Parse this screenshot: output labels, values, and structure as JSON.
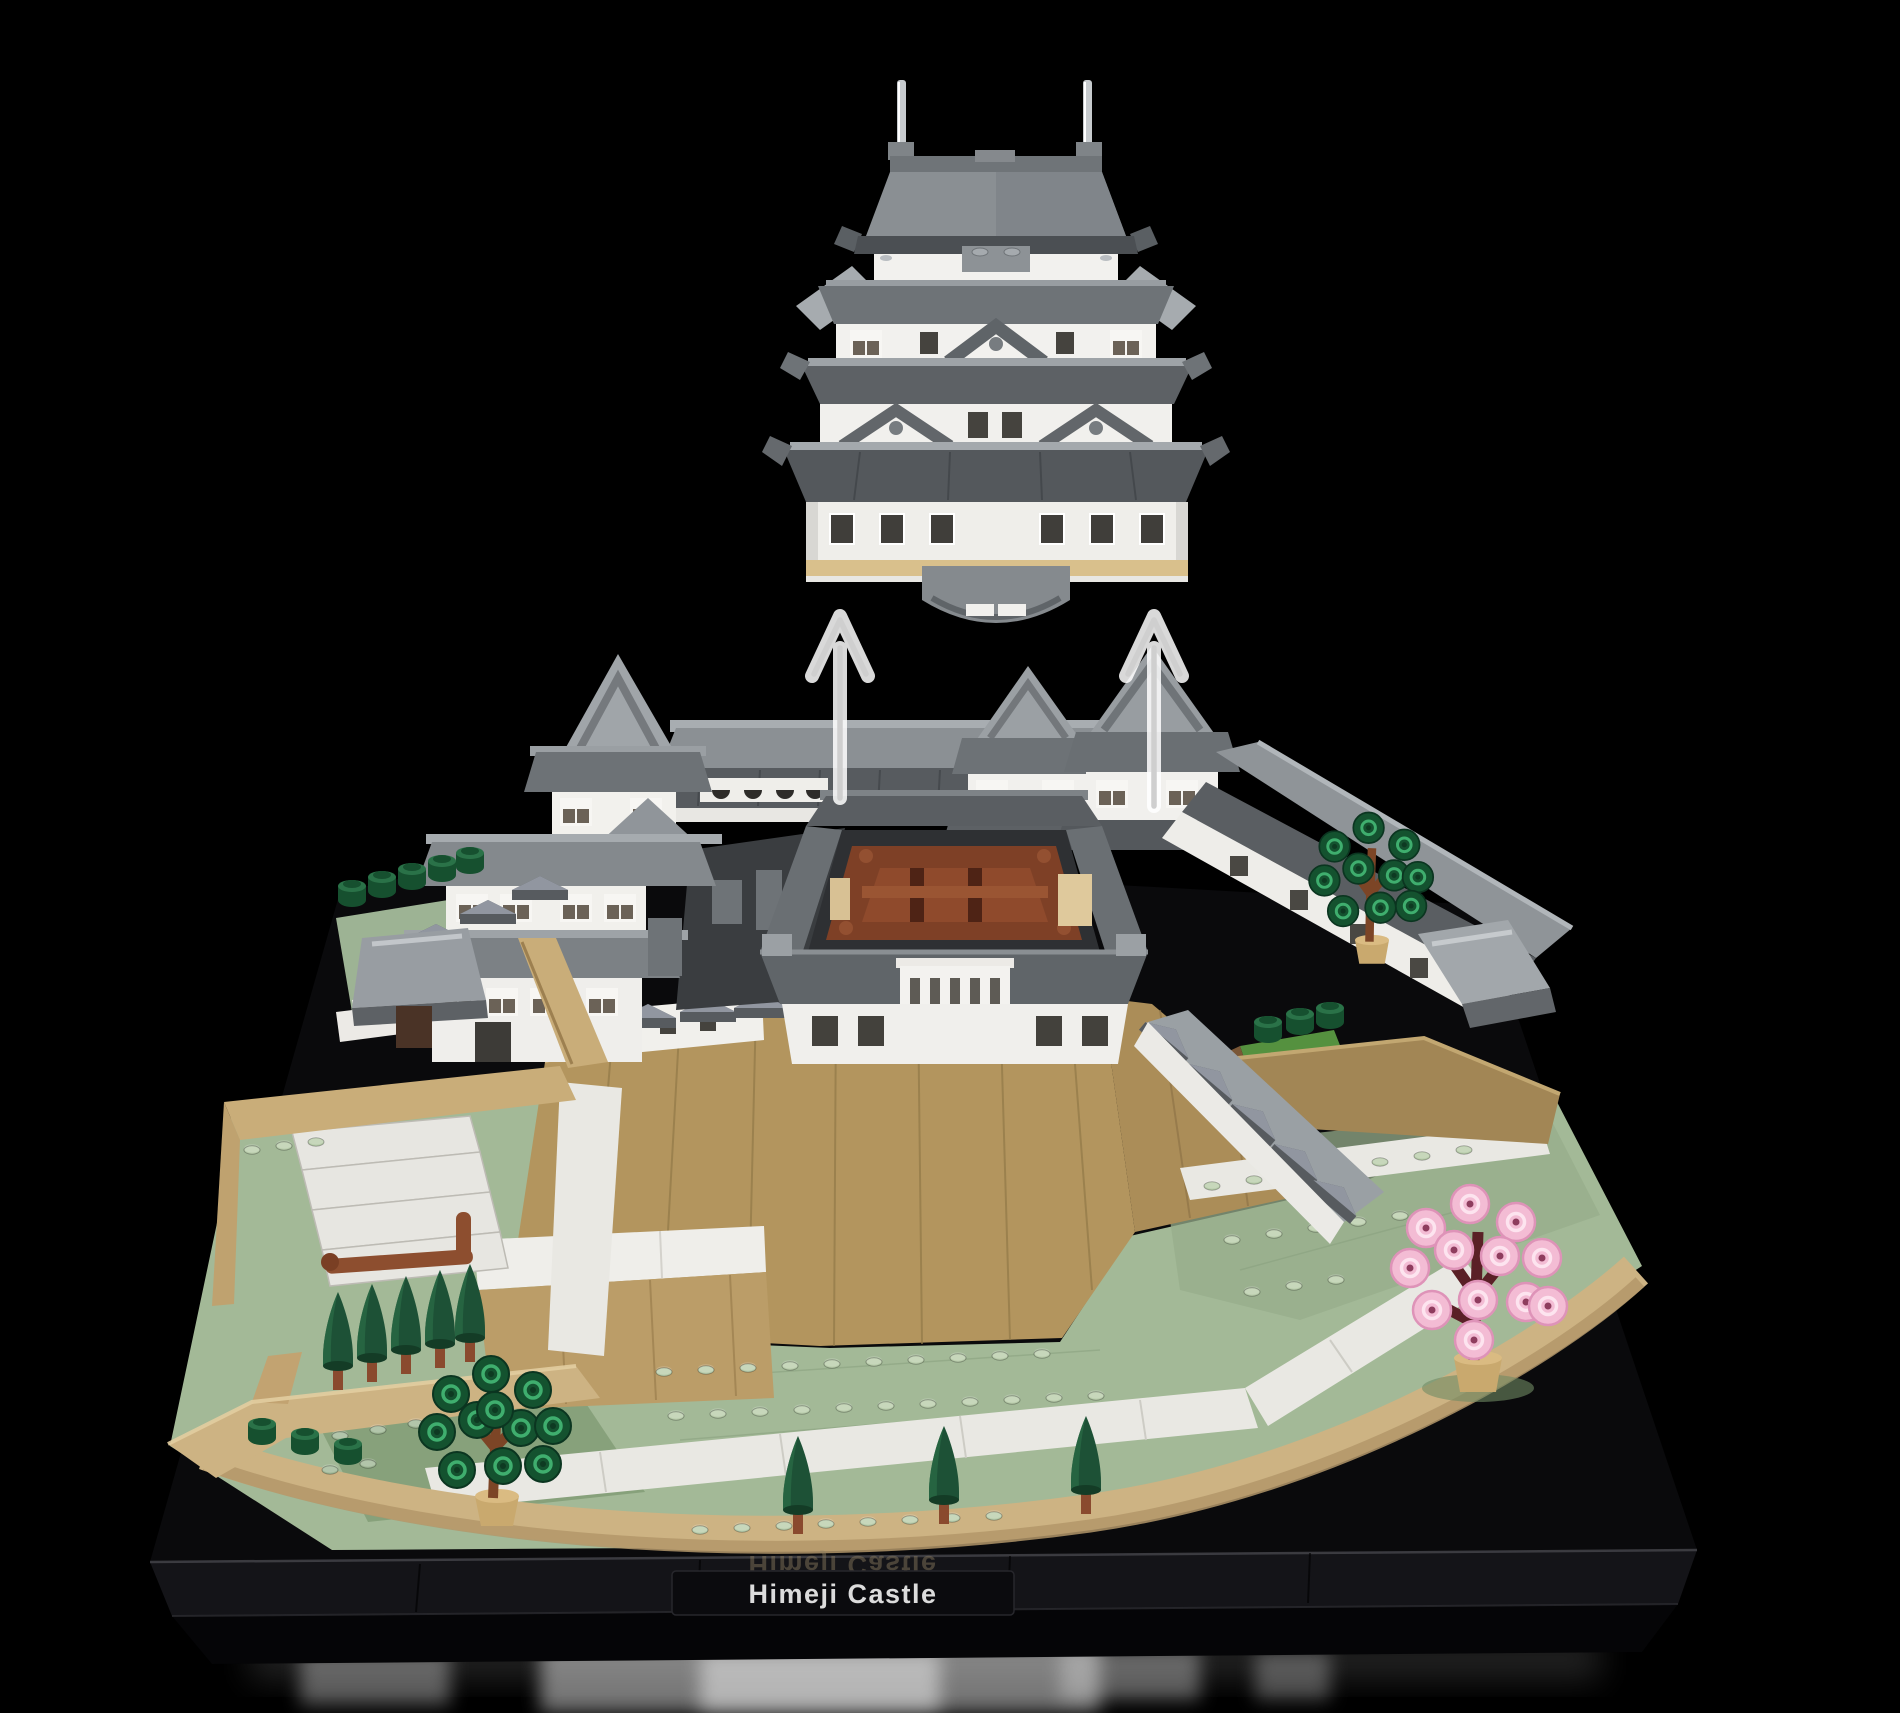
{
  "scene": {
    "subject": "LEGO model of Himeji Castle with its main keep lifted above the castle base",
    "background_color": "#000000",
    "view": "three-quarter front elevated"
  },
  "nameplate": {
    "text": "Himeji Castle",
    "reflection_text": "Himeji Castle",
    "text_color": "#dcdcdc",
    "plate_color": "#0b0b0e"
  },
  "assembly": {
    "arrow_count": 2,
    "arrow_direction": "up",
    "arrow_color": "#d4d4d4"
  },
  "stud_embossing": "LEGO",
  "palette": {
    "roof_light_gray": "#9aa0a4",
    "roof_mid_gray": "#84898d",
    "roof_dark_gray": "#565b5f",
    "wall_white": "#f1f0ed",
    "stone_tan": "#b3955e",
    "wall_tan": "#cdb383",
    "ground_green": "#a3b997",
    "pond_green": "#87a17b",
    "tree_green": "#1d5136",
    "blossom_pink": "#f3bcd4",
    "socket_brown": "#7e4026",
    "base_black": "#0a0a0c"
  },
  "vegetation": {
    "conifer_trees": 8,
    "round_foliage_trees": 2,
    "cherry_blossom_trees": 1,
    "bushes": 11
  },
  "structures": {
    "floating_keep_tiers": 4,
    "gabled_towers": 3,
    "keep_socket": "reddish-brown frame recess",
    "balustrade": "white fence below keep socket"
  }
}
